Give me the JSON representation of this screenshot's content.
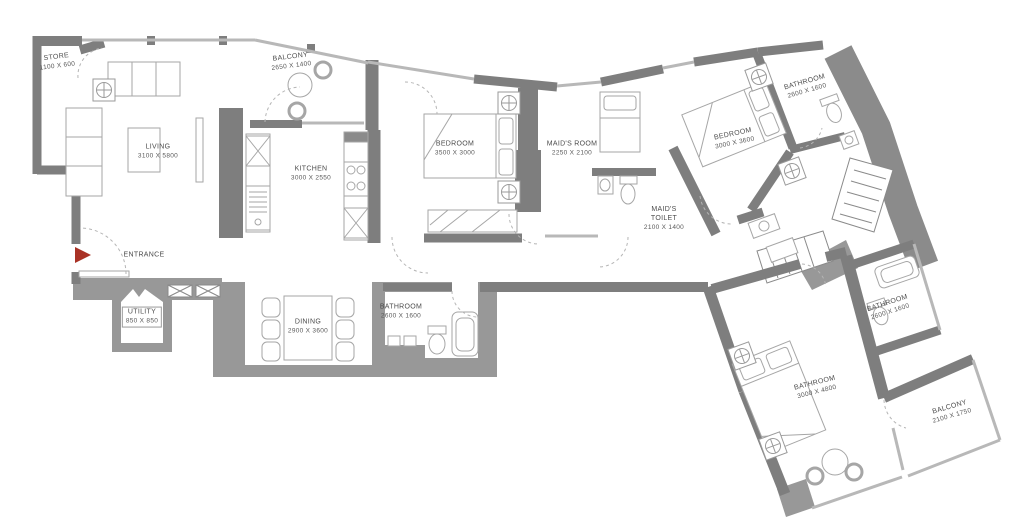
{
  "floorplan": {
    "entrance_label": "ENTRANCE",
    "colors": {
      "wall": "#7e7e7e",
      "mass": "#989898",
      "window": "#b8b8b8",
      "furniture": "#a6a6a6",
      "entrance_arrow": "#a93226",
      "text": "#4c4c4c"
    },
    "rooms": {
      "store": {
        "name": "STORE",
        "dims": "1100 X 600"
      },
      "living": {
        "name": "LIVING",
        "dims": "3100 X 5800"
      },
      "balcony_top": {
        "name": "BALCONY",
        "dims": "2650 X 1400"
      },
      "kitchen": {
        "name": "KITCHEN",
        "dims": "3000 X 2550"
      },
      "bedroom_center": {
        "name": "BEDROOM",
        "dims": "3500 X 3000"
      },
      "maids_room": {
        "name": "MAID'S ROOM",
        "dims": "2250 X 2100"
      },
      "maids_toilet": {
        "name": "MAID'S TOILET",
        "dims": "2100 X 1400"
      },
      "bedroom_right": {
        "name": "BEDROOM",
        "dims": "3000 X 3600"
      },
      "bathroom_top_right": {
        "name": "BATHROOM",
        "dims": "2600 X 1600"
      },
      "utility": {
        "name": "UTILITY",
        "dims": "850 X 850"
      },
      "dining": {
        "name": "DINING",
        "dims": "2900 X 3600"
      },
      "bathroom_bottom": {
        "name": "BATHROOM",
        "dims": "2600 X 1600"
      },
      "bathroom_right": {
        "name": "BATHROOM",
        "dims": "2600 X 1600"
      },
      "bathroom_master": {
        "name": "BATHROOM",
        "dims": "3000 X 4800"
      },
      "balcony_bottom": {
        "name": "BALCONY",
        "dims": "2100 X 1750"
      }
    }
  }
}
